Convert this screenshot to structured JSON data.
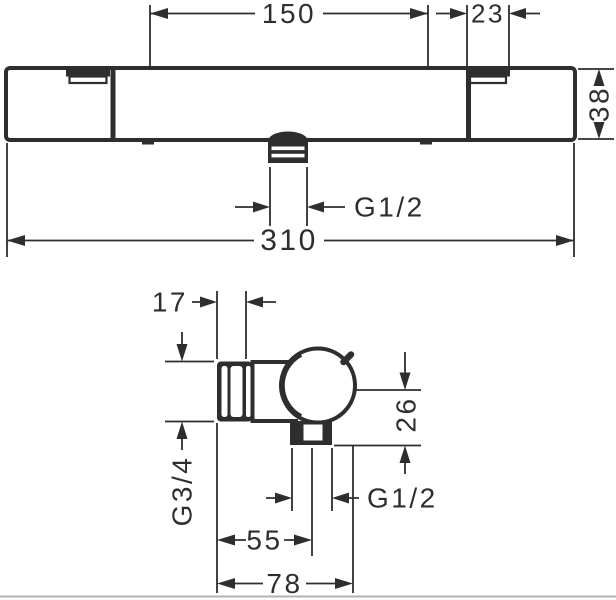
{
  "drawing": {
    "background": "#ffffff",
    "line_color": "#2e2e2e",
    "front_view": {
      "union_spacing": "150",
      "notch_width": "23",
      "body_height": "38",
      "total_width": "310",
      "outlet_thread": "G1/2"
    },
    "side_view": {
      "union_nut_depth": "17",
      "inlet_thread": "G3/4",
      "outlet_drop": "26",
      "outlet_thread": "G1/2",
      "outlet_depth": "55",
      "total_depth": "78"
    }
  }
}
